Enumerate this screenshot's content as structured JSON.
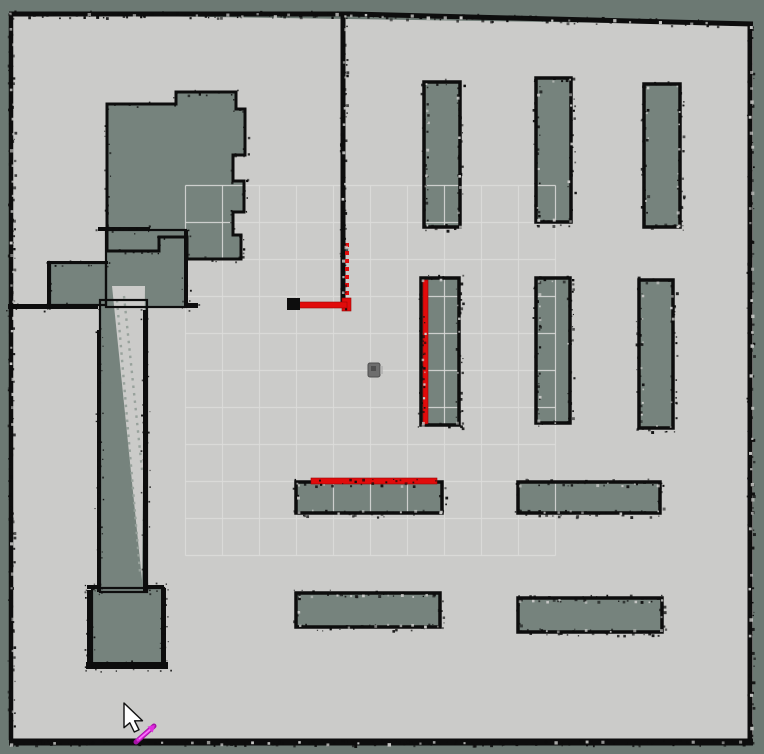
{
  "app": {
    "name": "occupancy-grid-map-view"
  },
  "colors": {
    "unknown": "#6c7973",
    "free": "#cbcbc9",
    "obstacle_fill": "#76837d",
    "wall": "#0d0d0d",
    "grid_line": "#dddddb",
    "corridor_dot": "#98a29c",
    "laser": "#e10b0b",
    "laser_dark": "#9b0606",
    "robot_body": "#6e6e6e",
    "robot_dark": "#4f4f4f",
    "robot_light": "#a8a8a8",
    "pose_arrow": "#a512a5",
    "pose_arrow_mid": "#e02ce0",
    "pose_arrow_core": "#ff7bff",
    "cursor_fill": "#ffffff",
    "cursor_outline": "#111111"
  },
  "map": {
    "width": 764,
    "height": 754,
    "free_area": [
      [
        9,
        14
      ],
      [
        753,
        25
      ],
      [
        753,
        741
      ],
      [
        9,
        741
      ]
    ],
    "boundary_walls": [
      {
        "name": "wall-top",
        "pts": [
          [
            9,
            14
          ],
          [
            350,
            14
          ],
          [
            753,
            24
          ]
        ],
        "w": 5
      },
      {
        "name": "wall-left",
        "pts": [
          [
            11,
            13
          ],
          [
            11,
            740
          ]
        ],
        "w": 4.5
      },
      {
        "name": "wall-right",
        "pts": [
          [
            750,
            25
          ],
          [
            750,
            741
          ]
        ],
        "w": 5
      },
      {
        "name": "wall-bottom",
        "pts": [
          [
            9,
            742
          ],
          [
            753,
            742
          ]
        ],
        "w": 7
      },
      {
        "name": "wall-center-vertical",
        "pts": [
          [
            343,
            14
          ],
          [
            343,
            307
          ]
        ],
        "w": 5
      }
    ],
    "rooms": [
      {
        "name": "room-blob-topleft",
        "polygon": [
          [
            107,
            104
          ],
          [
            176,
            104
          ],
          [
            176,
            92
          ],
          [
            236,
            92
          ],
          [
            236,
            109
          ],
          [
            245,
            109
          ],
          [
            245,
            155
          ],
          [
            233,
            155
          ],
          [
            233,
            181
          ],
          [
            244,
            181
          ],
          [
            244,
            212
          ],
          [
            233,
            212
          ],
          [
            233,
            235
          ],
          [
            241,
            235
          ],
          [
            241,
            259
          ],
          [
            187,
            259
          ],
          [
            187,
            237
          ],
          [
            159,
            237
          ],
          [
            159,
            251
          ],
          [
            107,
            251
          ]
        ]
      },
      {
        "name": "room-left-bar",
        "rect": [
          50,
          263,
          56,
          42
        ]
      },
      {
        "name": "corridor-head",
        "rect": [
          106,
          230,
          80,
          77
        ]
      },
      {
        "name": "corridor",
        "rect": [
          100,
          300,
          47,
          292
        ]
      },
      {
        "name": "room-bottom-square",
        "rect": [
          92,
          588,
          72,
          76
        ]
      }
    ],
    "corridor_light": {
      "polygon": [
        [
          112,
          286
        ],
        [
          145,
          286
        ],
        [
          142,
          580
        ]
      ],
      "dotted_lines": [
        [
          117,
          300,
          140,
          572
        ],
        [
          124,
          296,
          142,
          470
        ]
      ]
    },
    "interior_walls": [
      [
        48,
        261,
        60,
        3
      ],
      [
        47,
        261,
        3,
        45
      ],
      [
        8,
        304,
        90,
        5
      ],
      [
        98,
        227,
        52,
        4
      ],
      [
        184,
        230,
        4,
        76
      ],
      [
        184,
        303,
        14,
        5
      ],
      [
        97,
        330,
        4,
        262
      ],
      [
        143,
        310,
        4,
        282
      ],
      [
        87,
        585,
        14,
        4
      ],
      [
        147,
        585,
        17,
        4
      ],
      [
        87,
        590,
        5,
        74
      ],
      [
        161,
        588,
        5,
        76
      ],
      [
        86,
        662,
        82,
        7
      ]
    ],
    "shelves": [
      {
        "name": "shelf-top-1",
        "rect": [
          424,
          82,
          36,
          145
        ]
      },
      {
        "name": "shelf-top-2",
        "rect": [
          536,
          78,
          35,
          144
        ]
      },
      {
        "name": "shelf-top-3",
        "rect": [
          644,
          84,
          36,
          143
        ]
      },
      {
        "name": "shelf-mid-1",
        "rect": [
          421,
          278,
          38,
          147
        ]
      },
      {
        "name": "shelf-mid-2",
        "rect": [
          536,
          278,
          34,
          145
        ]
      },
      {
        "name": "shelf-mid-3",
        "rect": [
          639,
          280,
          34,
          148
        ]
      },
      {
        "name": "shelf-low-1",
        "rect": [
          296,
          482,
          146,
          31
        ]
      },
      {
        "name": "shelf-low-2",
        "rect": [
          518,
          482,
          142,
          31
        ]
      },
      {
        "name": "shelf-bottom-1",
        "rect": [
          296,
          593,
          144,
          34
        ]
      },
      {
        "name": "shelf-bottom-2",
        "rect": [
          518,
          598,
          144,
          34
        ]
      }
    ],
    "grid": {
      "x0": 185.5,
      "y0": 185.5,
      "step": 37,
      "lines": 11
    },
    "laser": {
      "dashed_vertical": {
        "x": 347,
        "y1": 243,
        "y2": 303,
        "w": 4,
        "dash": "4 4"
      },
      "segments": [
        [
          342,
          298,
          9,
          13
        ],
        [
          295,
          302,
          52,
          6
        ],
        [
          423,
          280,
          5,
          144
        ],
        [
          311,
          478,
          126,
          6
        ]
      ],
      "black_cap": [
        287,
        298,
        13,
        12
      ]
    },
    "robot": {
      "x": 368,
      "y": 363,
      "w": 12,
      "h": 14
    },
    "pose_arrow": {
      "x1": 136,
      "y1": 742,
      "x2": 154,
      "y2": 726
    },
    "cursor": {
      "tip_x": 124,
      "tip_y": 703
    }
  }
}
